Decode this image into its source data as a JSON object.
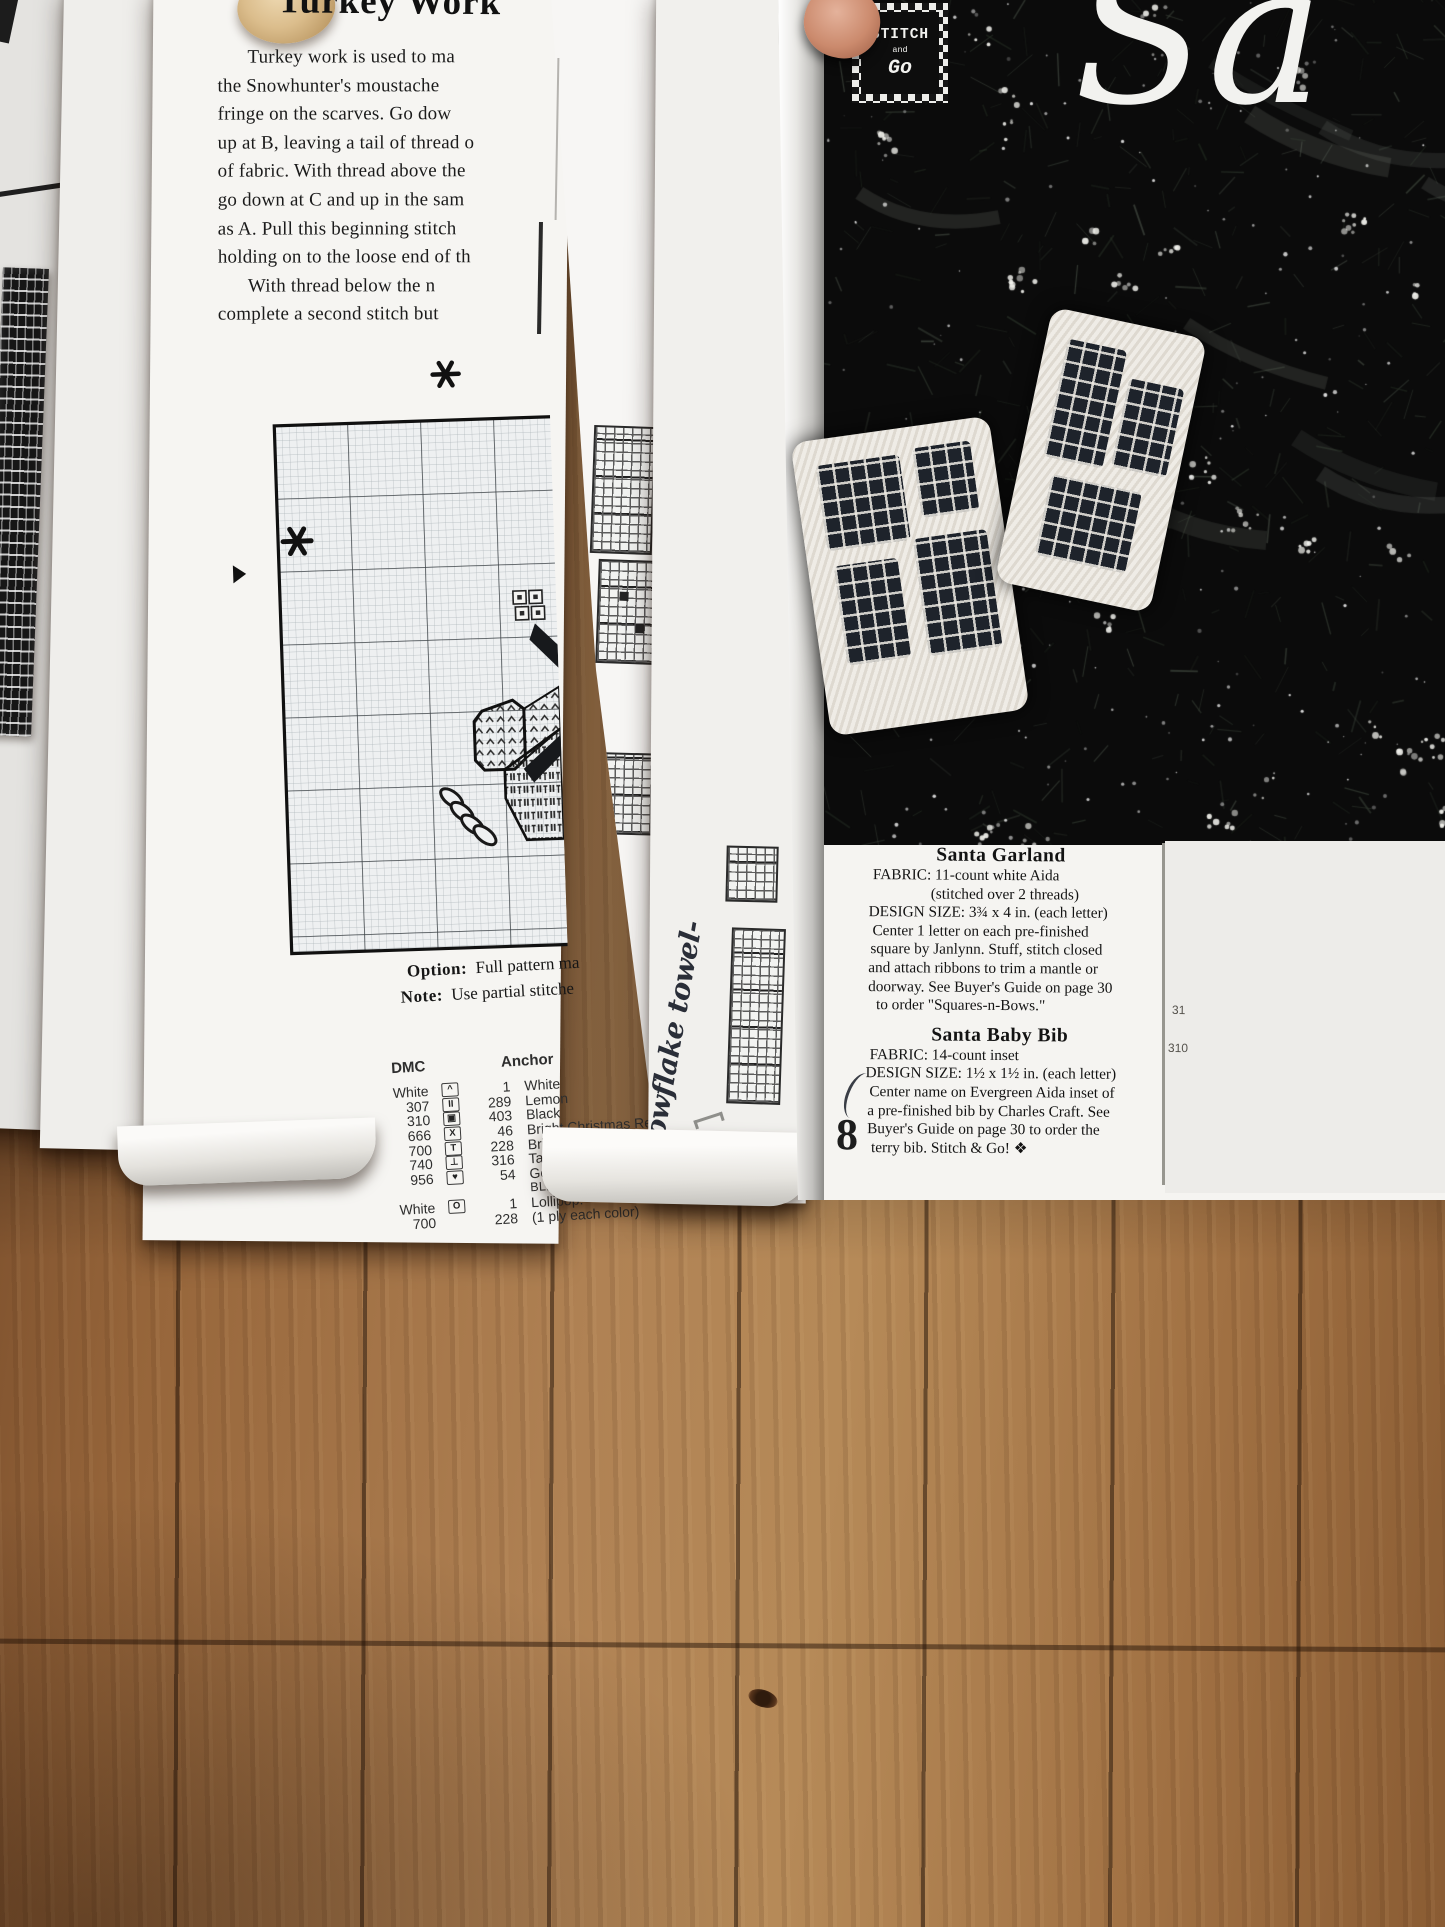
{
  "turkey_page": {
    "heading": "Turkey Work",
    "body_lines": [
      "Turkey work is used to ma",
      "the Snowhunter's moustache",
      "fringe on the scarves. Go dow",
      "up at B, leaving a tail of thread o",
      "of fabric. With thread above the",
      "go down at C and up in the sam",
      "as A. Pull this beginning stitch",
      "holding on to the loose end of th",
      "With thread below the n",
      "complete a second stitch but"
    ],
    "chart_note": {
      "option_label": "Option:",
      "option_text": "Full pattern ma",
      "note_label": "Note:",
      "note_text": "Use partial stitche"
    },
    "legend": {
      "dmc_header": "DMC",
      "anchor_header": "Anchor",
      "rows": [
        {
          "dmc": "White",
          "sym": "^",
          "anchor": "1",
          "name": "White"
        },
        {
          "dmc": "307",
          "sym": "II",
          "anchor": "289",
          "name": "Lemon"
        },
        {
          "dmc": "310",
          "sym": "▣",
          "anchor": "403",
          "name": "Black"
        },
        {
          "dmc": "666",
          "sym": "X",
          "anchor": "46",
          "name": "Bright Christmas Red"
        },
        {
          "dmc": "700",
          "sym": "T",
          "anchor": "228",
          "name": "Bright Christmas Green"
        },
        {
          "dmc": "740",
          "sym": "⊥",
          "anchor": "316",
          "name": "Tangerine"
        },
        {
          "dmc": "956",
          "sym": "♥",
          "anchor": "54",
          "name": "Geranium"
        },
        {
          "dmc": "",
          "sym": "",
          "anchor": "",
          "name": "BLENDED NEEDLE"
        },
        {
          "dmc": "White",
          "sym": "O",
          "anchor": "1",
          "name": "Lollipop:"
        },
        {
          "dmc": "700",
          "sym": "",
          "anchor": "228",
          "name": "(1 ply each color)"
        }
      ]
    }
  },
  "handwriting": "Snowflake towel-",
  "right_page": {
    "logo": {
      "word1": "STITCH",
      "word2": "and",
      "word3": "Go"
    },
    "script_title": "Sa",
    "garland_title": "Santa Garland",
    "garland_lines": [
      "FABRIC: 11-count white Aida",
      "(stitched over 2 threads)",
      "DESIGN SIZE: 3¾ x 4 in. (each letter)",
      "Center 1 letter on each pre-finished",
      "square by Janlynn. Stuff, stitch closed",
      "and attach ribbons to trim a mantle or",
      "doorway. See Buyer's Guide on page 30",
      "to order \"Squares-n-Bows.\""
    ],
    "bib_title": "Santa Baby Bib",
    "bib_lines": [
      "FABRIC: 14-count inset",
      "DESIGN SIZE: 1½ x 1½ in. (each letter)",
      "Center name on Evergreen Aida inset of",
      "a pre-finished bib by Charles Craft. See",
      "Buyer's Guide on page 30 to order  the",
      "terry bib. Stitch & Go! ❖"
    ],
    "page_number": "8",
    "edge_numbers": {
      "a": "31",
      "b": "310"
    }
  }
}
